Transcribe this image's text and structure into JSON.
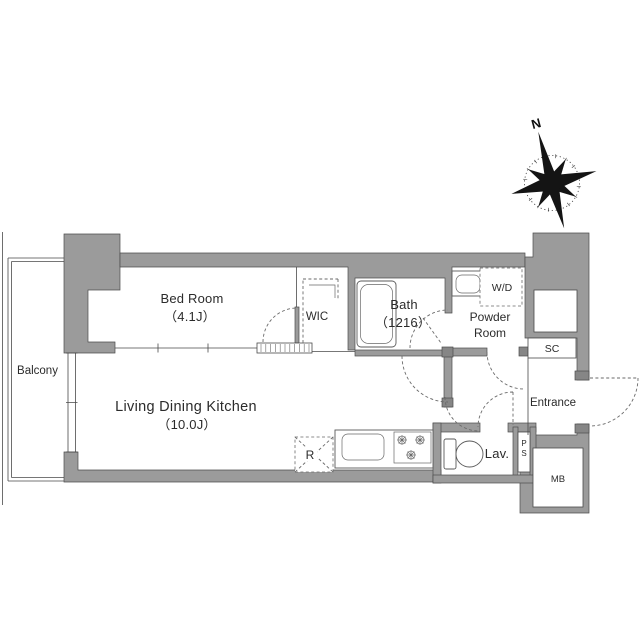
{
  "colors": {
    "wall_gray": "#9b9b9b",
    "wall_post_gray": "#868686",
    "line_dark": "#4a4a4a",
    "background": "#ffffff",
    "text": "#2b2b2b"
  },
  "compass": {
    "north_label": "N"
  },
  "rooms": {
    "balcony": {
      "label": "Balcony"
    },
    "bedroom": {
      "label": "Bed Room",
      "size": "（4.1J）"
    },
    "wic": {
      "label": "WIC"
    },
    "bath": {
      "label": "Bath",
      "size": "（1216）"
    },
    "powder": {
      "label_line1": "Powder",
      "label_line2": "Room"
    },
    "wd": {
      "label": "W/D"
    },
    "sc": {
      "label": "SC"
    },
    "entrance": {
      "label": "Entrance"
    },
    "ldk": {
      "label": "Living Dining Kitchen",
      "size": "（10.0J）"
    },
    "lav": {
      "label": "Lav."
    },
    "ps": {
      "letter1": "P",
      "letter2": "S"
    },
    "mb": {
      "label": "MB"
    },
    "fridge": {
      "label": "R"
    }
  }
}
